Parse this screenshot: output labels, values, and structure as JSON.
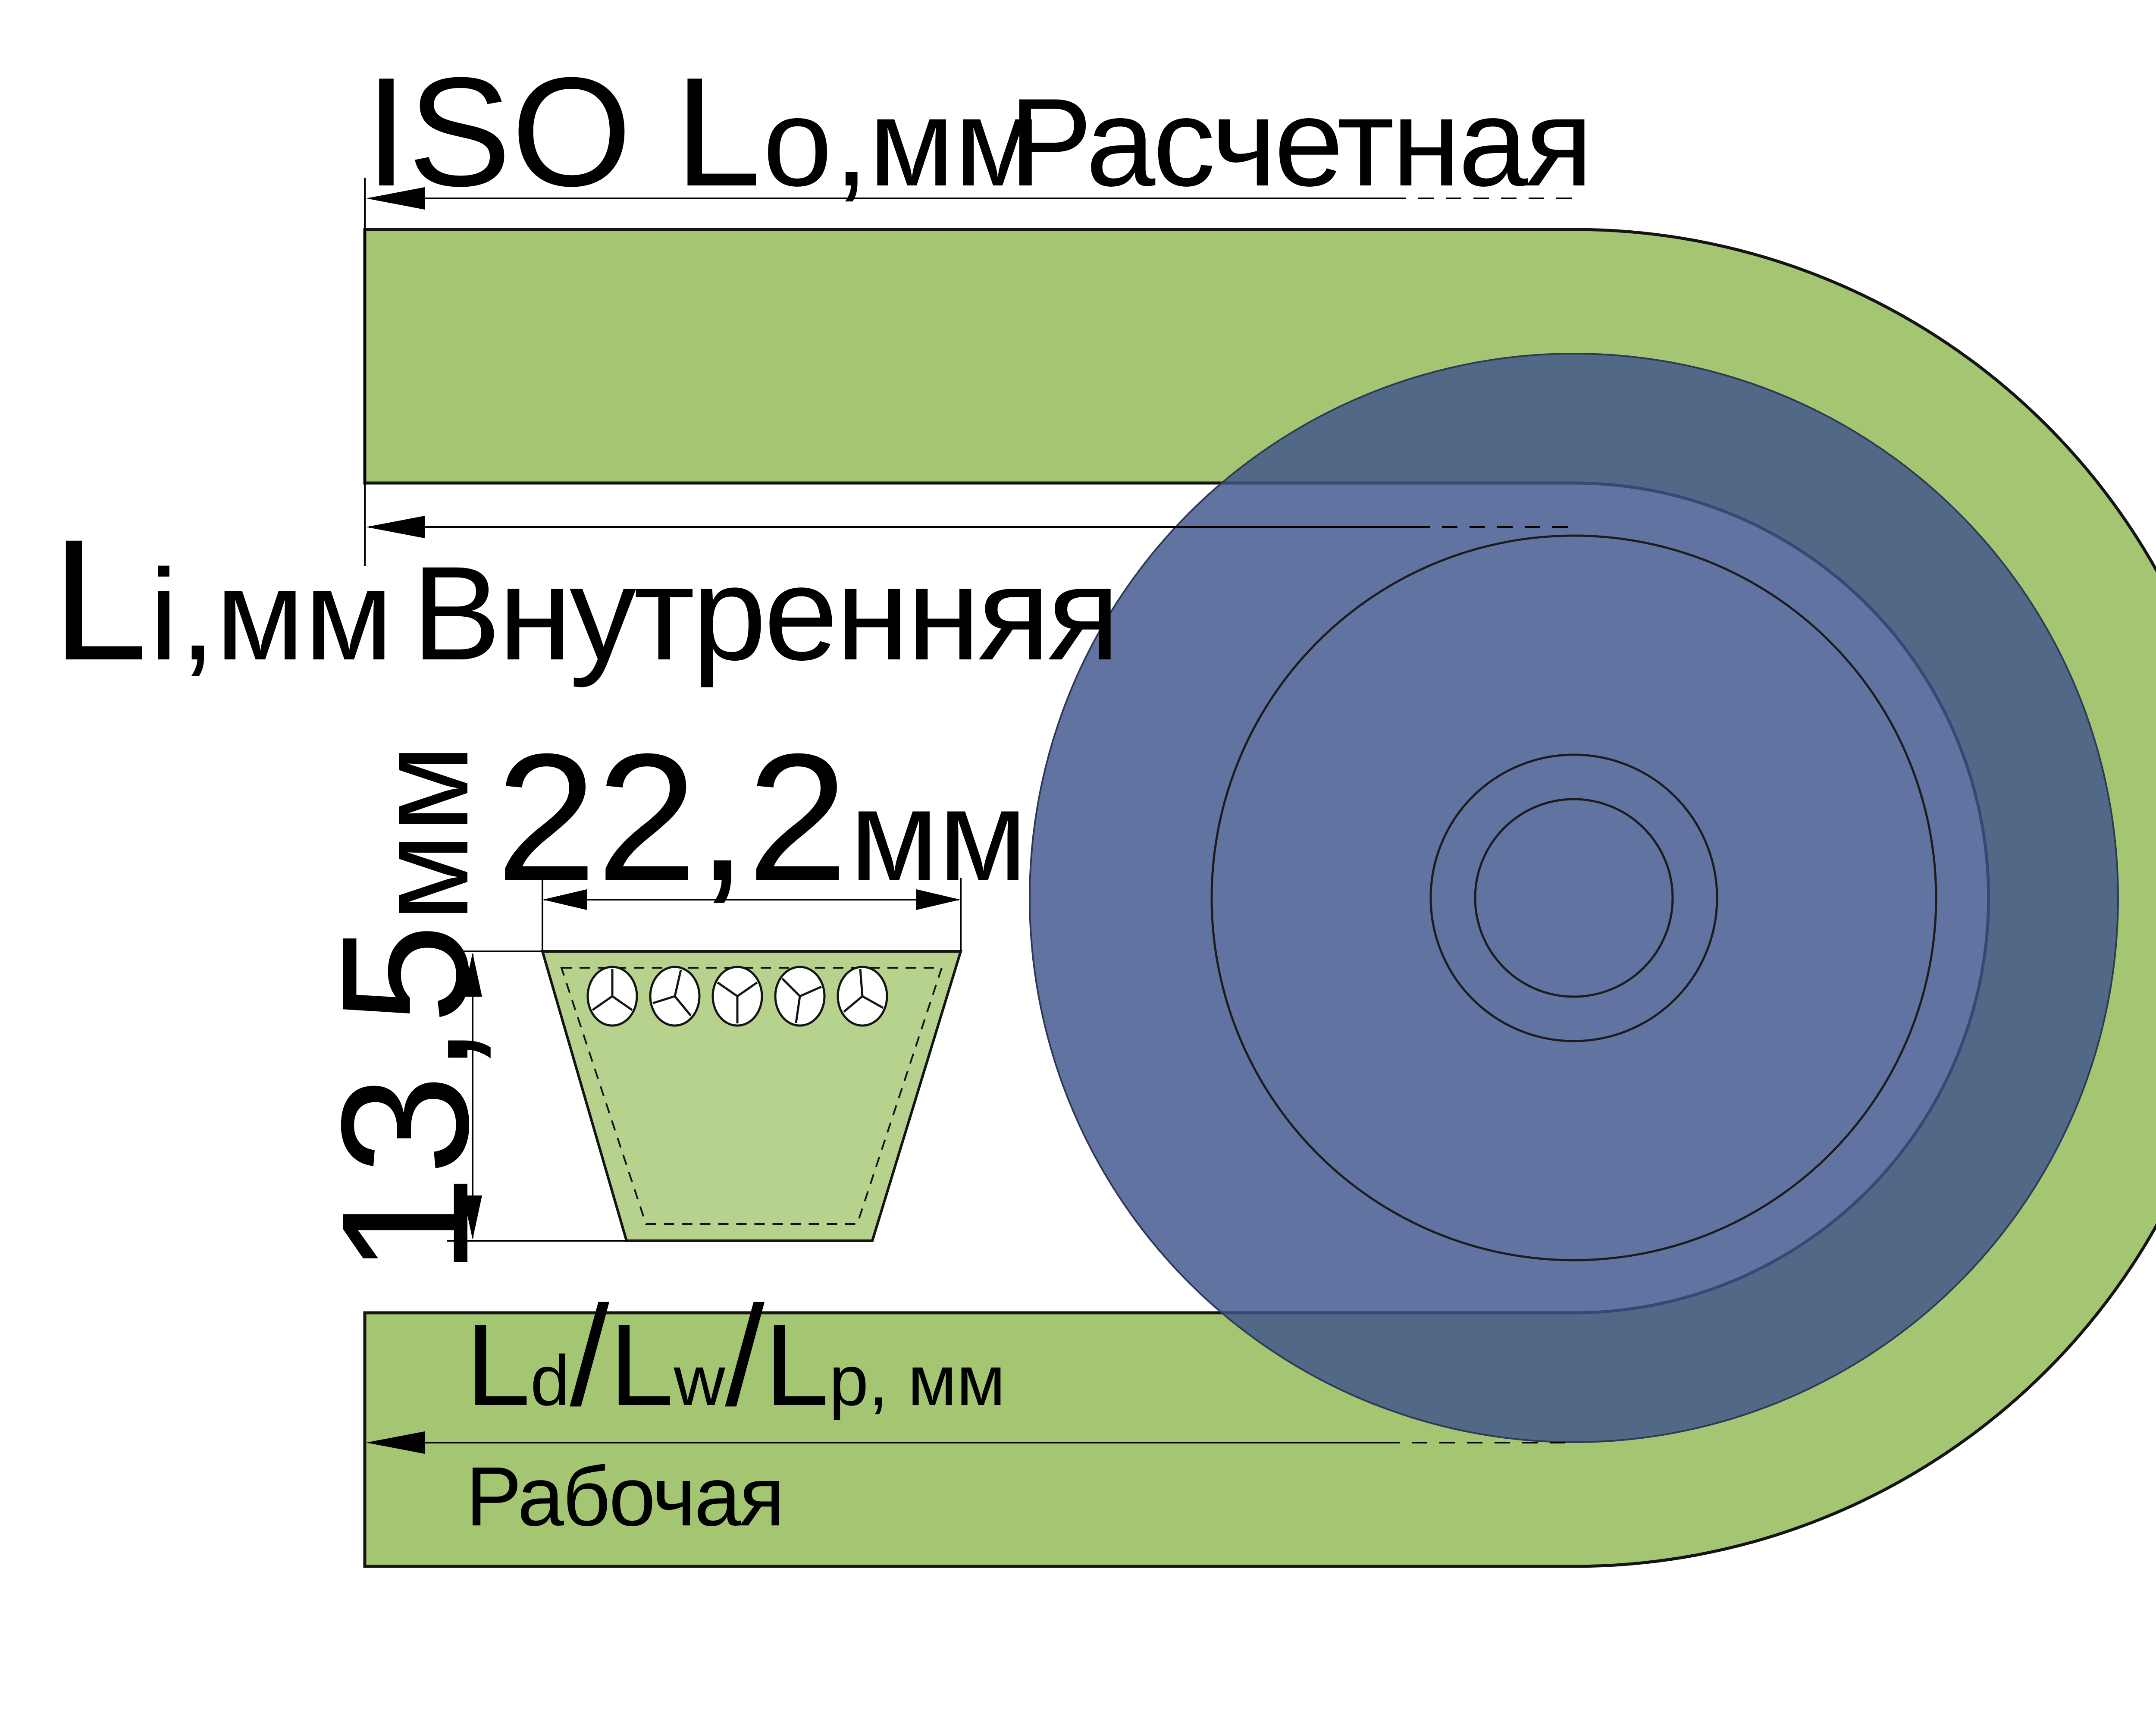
{
  "colors": {
    "background": "#ffffff",
    "belt_green": "#a4c672",
    "section_green": "#b6d28c",
    "pulley_blue": "#3e548c",
    "outline_black": "#141414"
  },
  "dimension_labels": {
    "outer_length": {
      "prefix": "ISO L",
      "subscript": "o",
      "units": ",мм",
      "caption": "Расчетная"
    },
    "inner_length": {
      "prefix": "L",
      "subscript": "i",
      "units": ",мм",
      "caption": "Внутренняя"
    },
    "working_length": {
      "l1": "L",
      "s1": "d",
      "sep1": "/",
      "l2": "L",
      "s2": "w",
      "sep2": "/",
      "l3": "L",
      "s3": "p",
      "units": ", мм",
      "caption": "Рабочая"
    },
    "section_width": {
      "value": "22,2",
      "units": "мм"
    },
    "section_height": {
      "value": "13,5",
      "units": "мм"
    }
  }
}
